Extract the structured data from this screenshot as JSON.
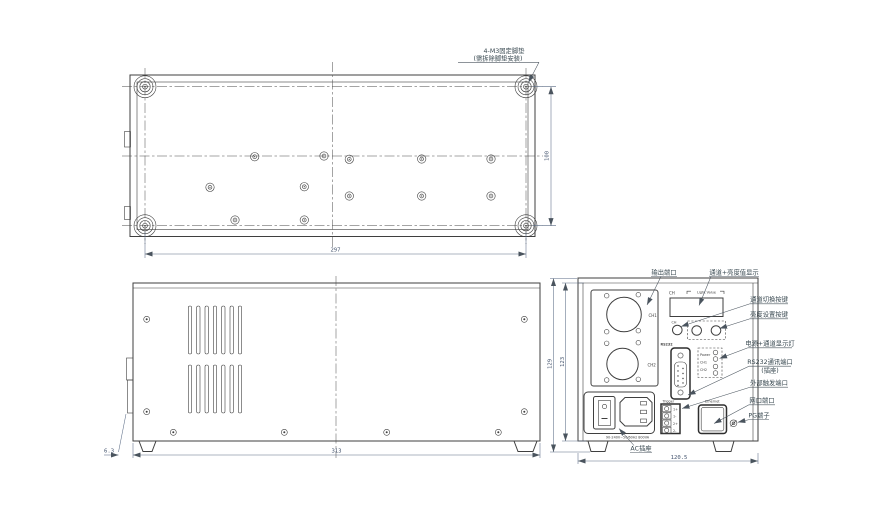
{
  "drawing": {
    "background_color": "#ffffff",
    "line_color": "#3f3f3f",
    "dimension_color": "#44546e",
    "callout_color": "#37474f",
    "bottom_view": {
      "callout_line1": "4-M3固定脚垫",
      "callout_line2": "(需拆除脚垫安装)",
      "dim_width": "297",
      "dim_depth": "100"
    },
    "side_view": {
      "dim_length": "313",
      "dim_foot_offset": "6.3"
    },
    "rear_view": {
      "dim_width": "120.5",
      "dim_height_overall": "129",
      "dim_height_body": "123",
      "display_ch": "CH",
      "display_value": "Light Value",
      "btn_ch": "CH",
      "out_ch1": "CH1",
      "out_ch2": "CH2",
      "rs232": "RS232",
      "led_power": "Power",
      "led_ch1": "CH1",
      "led_ch2": "CH2",
      "trigger": "Trigger",
      "t1p": "1+",
      "t1m": "1-",
      "t2p": "2+",
      "t2m": "2-",
      "ethernet": "Ethernet",
      "ac_rating": "90-240V~50/60Hz 800VA",
      "callouts": {
        "output_port": "输出端口",
        "display": "通道+亮度值显示",
        "ch_switch": "通道切换按键",
        "brightness": "亮度设置按键",
        "leds": "电源+通道显示灯",
        "rs232_line1": "RS232通讯端口",
        "rs232_line2": "(插座)",
        "trigger": "外部触发端口",
        "lan": "网口端口",
        "pg": "PG端子",
        "ac": "AC插座"
      }
    }
  }
}
